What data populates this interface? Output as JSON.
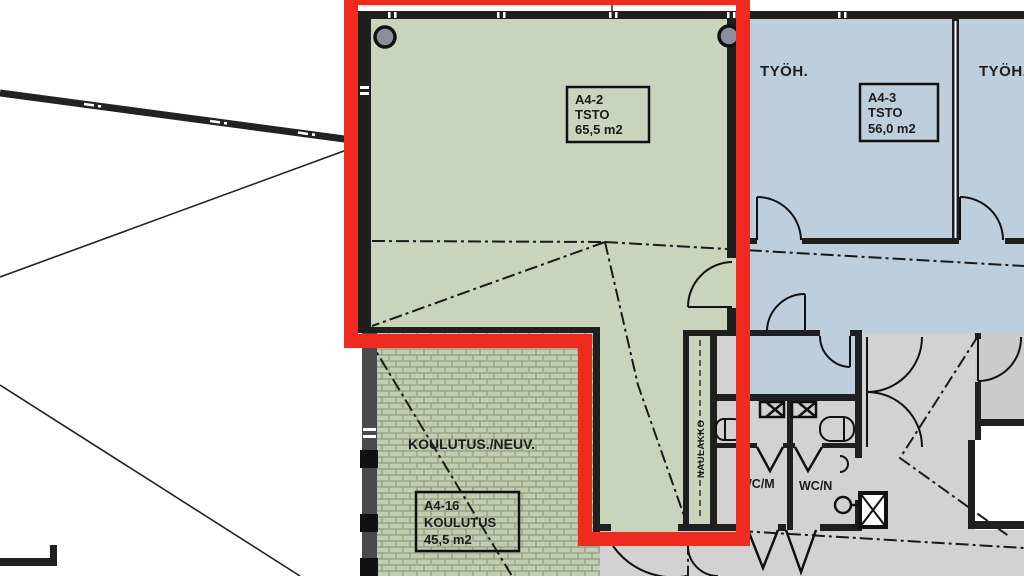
{
  "plan": {
    "rooms": {
      "a4_2": {
        "id": "A4-2",
        "type": "TSTO",
        "area": "65,5 m2"
      },
      "a4_3": {
        "id": "A4-3",
        "type": "TSTO",
        "area": "56,0 m2"
      },
      "a4_16": {
        "id": "A4-16",
        "type": "KOULUTUS",
        "area": "45,5 m2"
      },
      "tyoh_left": {
        "label": "TYÖH."
      },
      "tyoh_right": {
        "label": "TYÖH."
      },
      "koulutus_neuv": {
        "label": "KOULUTUS./NEUV."
      },
      "naulakko": {
        "label": "NAULAKKO"
      },
      "wc_m": {
        "label": "WC/M"
      },
      "wc_n": {
        "label": "WC/N"
      }
    },
    "colors": {
      "highlight_red": "#ee2b1e",
      "room_green": "#cad3bc",
      "room_blue": "#bdcfdc",
      "corridor_gray": "#d2d2d2",
      "hatch_green": "#c2ccb2",
      "wall_dark": "#1f1f1f"
    }
  }
}
